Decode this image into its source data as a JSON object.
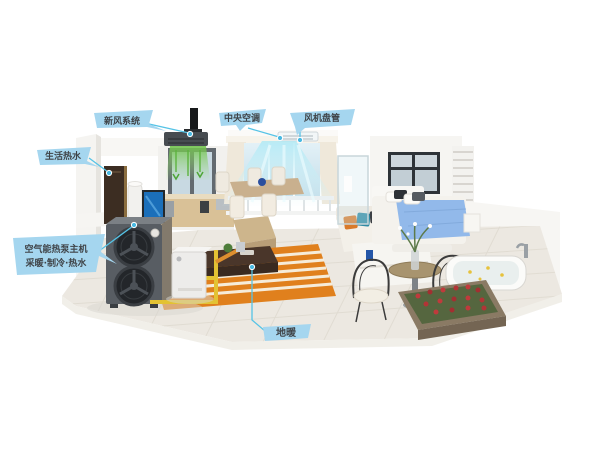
{
  "callouts": {
    "fresh_air": {
      "label": "新风系统"
    },
    "central_ac": {
      "label": "中央空调"
    },
    "fan_coil": {
      "label": "风机盘管"
    },
    "hot_water": {
      "label": "生活热水"
    },
    "heat_pump": {
      "label_line1": "空气能热泵主机",
      "label_line2": "采暖·制冷·热水"
    },
    "floor_heating": {
      "label": "地暖"
    }
  },
  "colors": {
    "callout_bubble": "#a5d6ef",
    "callout_text": "#3f4347",
    "connector_line": "#55c3e6",
    "cool_air_flow": "#9fe2f2",
    "fresh_air_flow": "#6fc24b",
    "pipe_hot_water": "#e3c233",
    "pipe_heating": "#dd8f2f",
    "floor_heating_rug": "#e0801d",
    "bed_blanket": "#92b9ea",
    "flower_bed": "#c03a3c",
    "heat_pump_body": "#585d63"
  },
  "components": [
    "heat-pump-outdoor-unit",
    "hydraulic-module",
    "water-heater-tank",
    "fan-coil-cabinet",
    "fresh-air-duct-unit",
    "ceiling-air-vent",
    "cool-air-curtain",
    "fresh-air-flow",
    "floor-heating-rug",
    "dining-set",
    "coffee-table",
    "sofa",
    "bed",
    "round-table",
    "wire-chairs",
    "bathtub",
    "flower-bed",
    "kitchen",
    "living-window",
    "bedroom-window"
  ]
}
